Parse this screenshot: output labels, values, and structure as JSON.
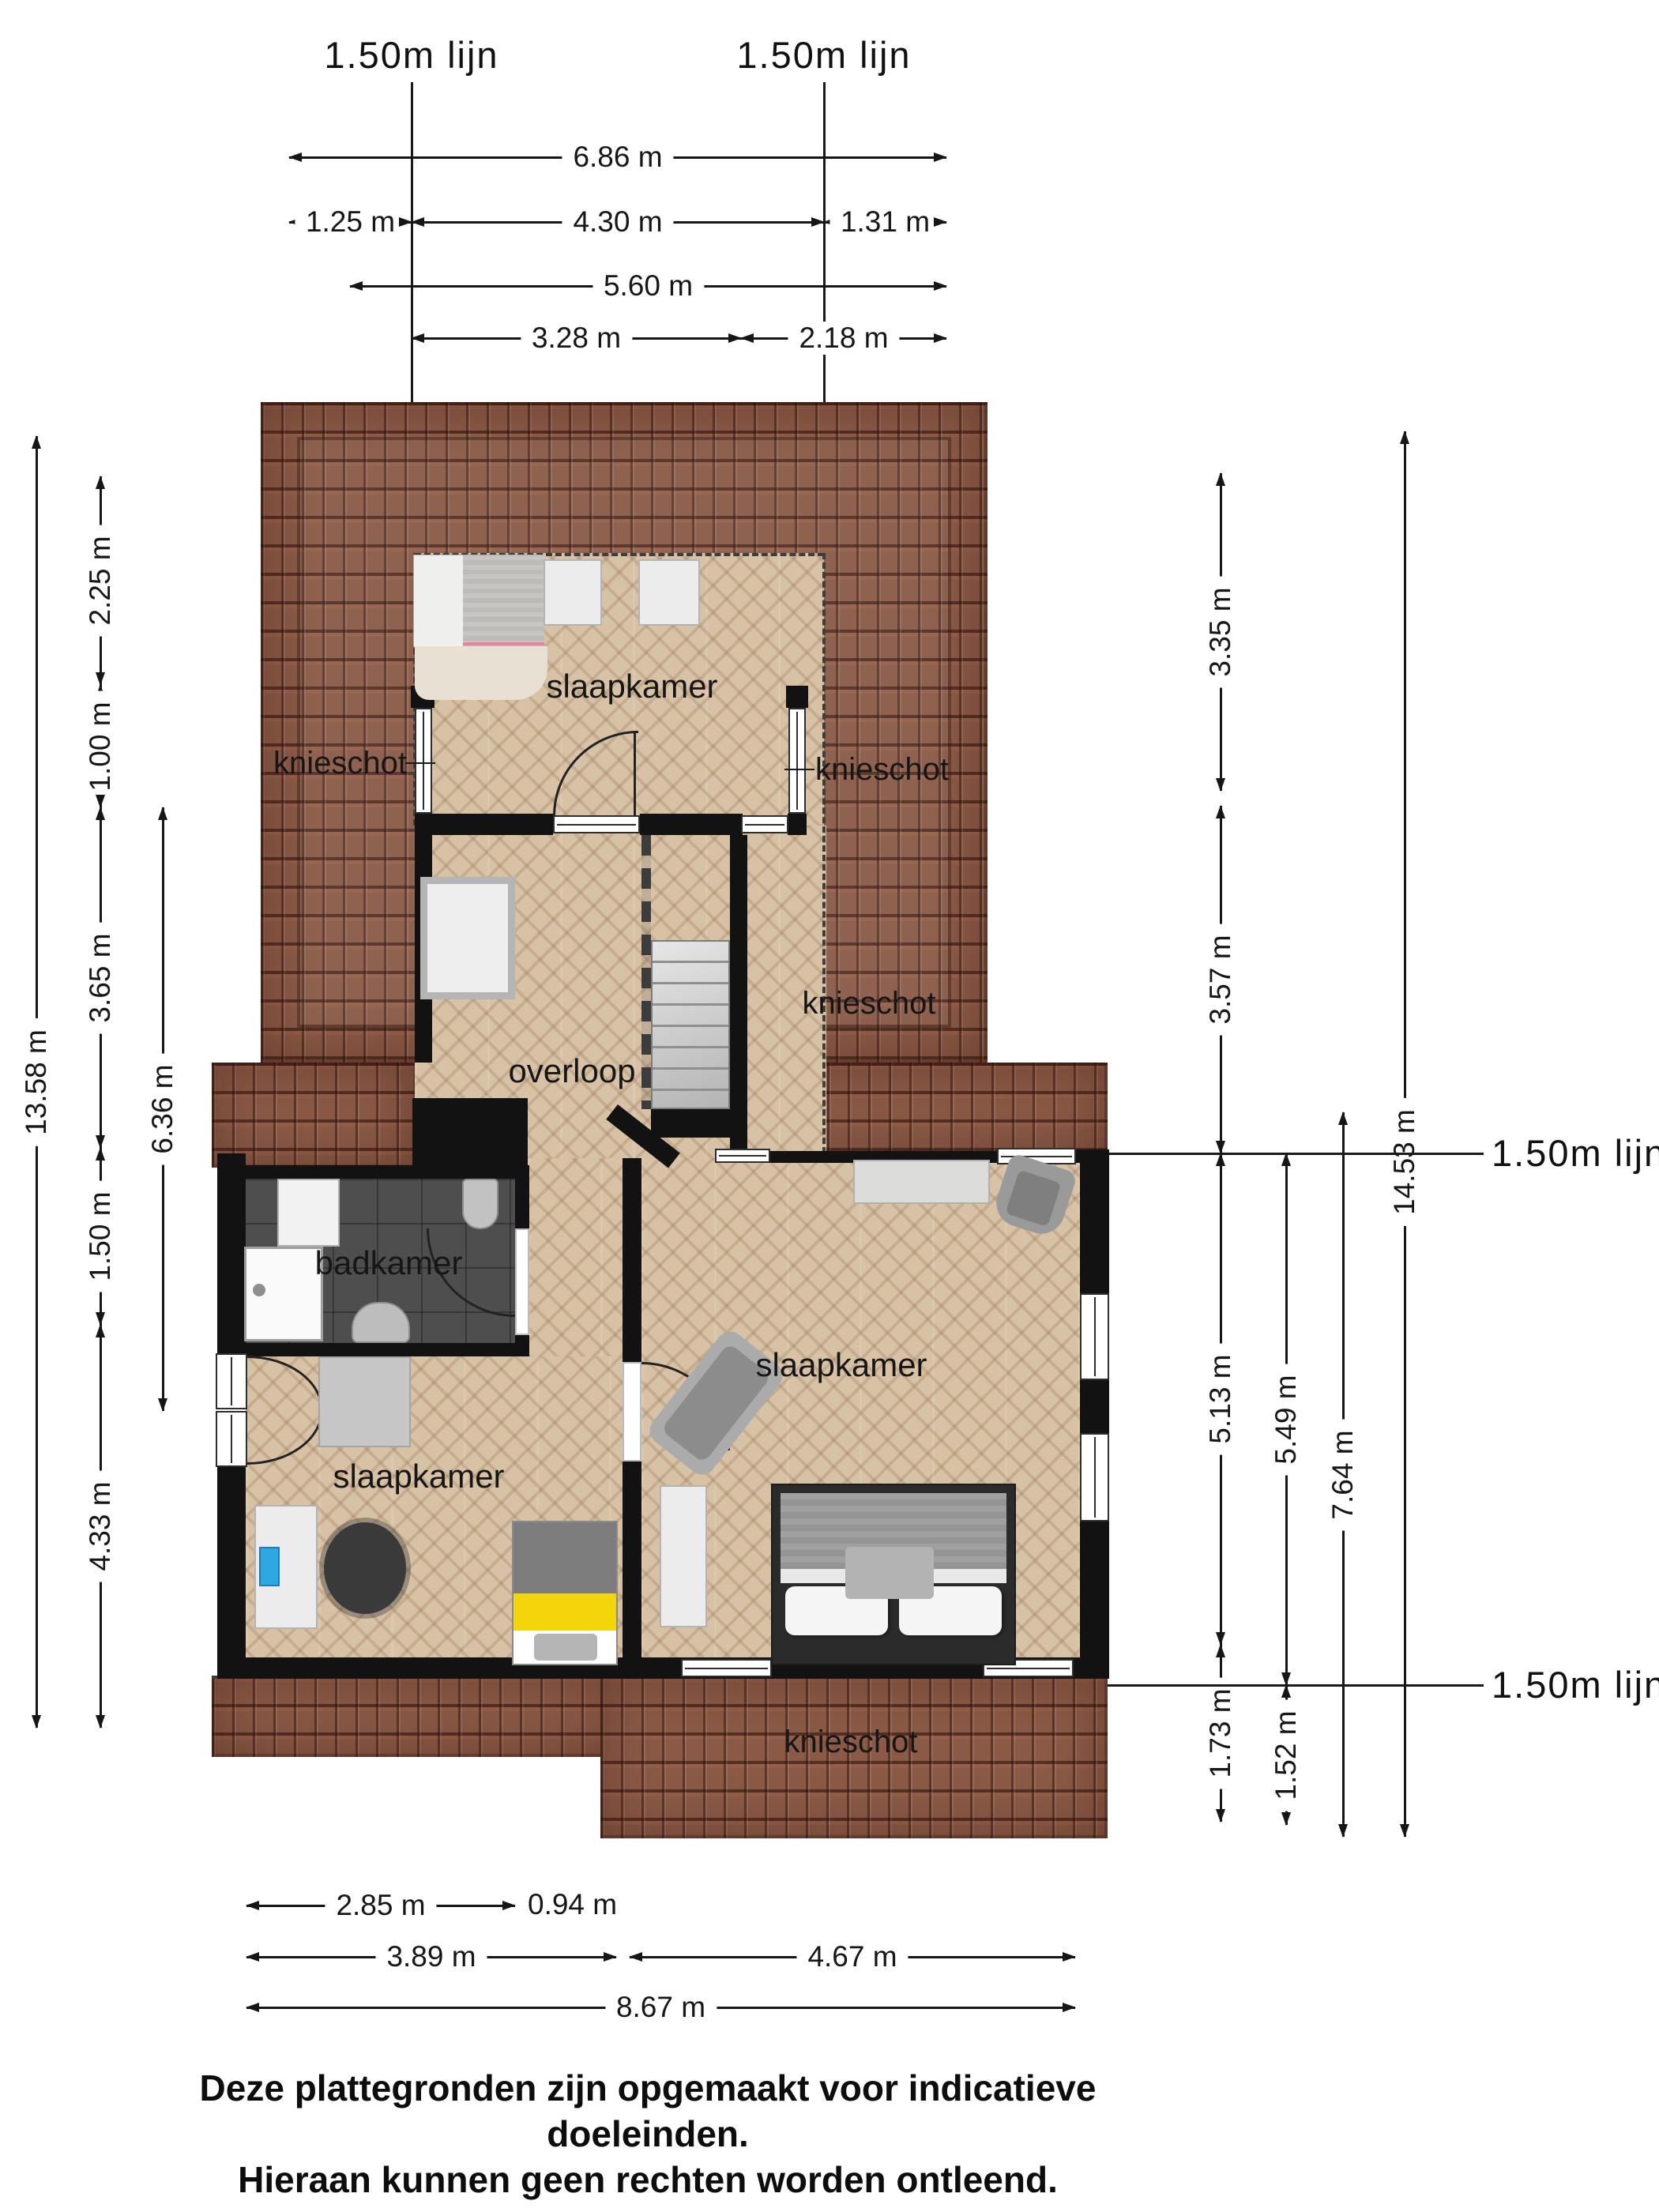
{
  "colors": {
    "roof-base": "#8a5a46",
    "roof-dark": "#53291e",
    "floor-base": "#d8c2a6",
    "bath-floor": "#4e4e4e",
    "wall": "#121212",
    "dim": "#161616",
    "accent-yellow": "#f2d50a",
    "accent-pink": "#e8849d",
    "accent-blue": "#2fa7e0",
    "stair": "#cdcdcd",
    "bed-frame": "#2b2b2b"
  },
  "lijn": {
    "label": "1.50m lijn"
  },
  "rooms": {
    "bedroom": "slaapkamer",
    "landing": "overloop",
    "bathroom": "badkamer",
    "kneewall": "knieschot"
  },
  "dims": {
    "top_row1": "6.86 m",
    "top_row2a": "1.25 m",
    "top_row2b": "4.30 m",
    "top_row2c": "1.31 m",
    "top_row3": "5.60 m",
    "top_row4a": "3.28 m",
    "top_row4b": "2.18 m",
    "left_total": "13.58 m",
    "left_a": "2.25 m",
    "left_b": "1.00 m",
    "left_c": "3.65 m",
    "left_d": "1.50 m",
    "left_e": "4.33 m",
    "left_inner": "6.36 m",
    "right_a": "3.35 m",
    "right_b": "3.57 m",
    "right_c": "5.13 m",
    "right_d": "1.73 m",
    "right_e": "5.49 m",
    "right_f": "1.52 m",
    "right_g": "7.64 m",
    "right_total": "14.53 m",
    "bottom_a": "2.85 m",
    "bottom_b": "0.94 m",
    "bottom_c": "3.89 m",
    "bottom_d": "4.67 m",
    "bottom_total": "8.67 m"
  },
  "disclaimer": {
    "line1": "Deze plattegronden zijn opgemaakt voor indicatieve doeleinden.",
    "line2": "Hieraan kunnen geen rechten worden ontleend."
  }
}
